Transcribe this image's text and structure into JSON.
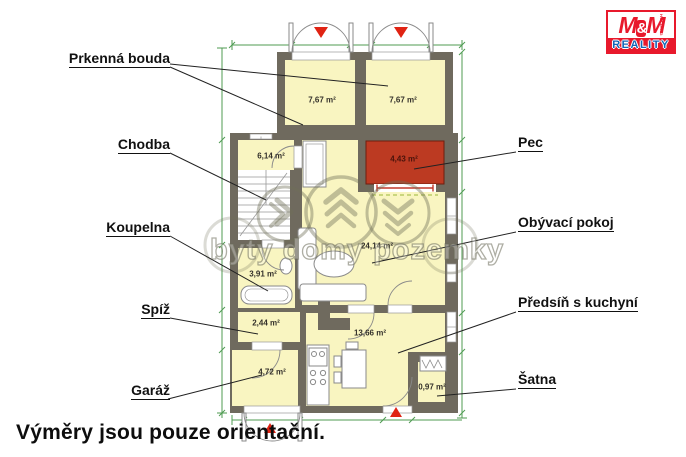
{
  "note": "Výměry jsou pouze orientační.",
  "watermark": "byty domy pozemky",
  "logo": {
    "m1": "M",
    "amp": "&",
    "m2": "M",
    "reality": "REALITY",
    "holding": "HOLDING"
  },
  "labels": {
    "prkenna_bouda": "Prkenná bouda",
    "chodba": "Chodba",
    "koupelna": "Koupelna",
    "spiz": "Spíž",
    "garaz": "Garáž",
    "pec": "Pec",
    "obyvaci_pokoj": "Obývací pokoj",
    "predsin": "Předsíň s kuchyní",
    "satna": "Šatna"
  },
  "areas": {
    "bouda_left": "7,67 m²",
    "bouda_right": "7,67 m²",
    "chodba": "6,14 m²",
    "pec": "4,43 m²",
    "obyvaci": "24,14 m²",
    "koupelna": "3,91 m²",
    "spiz": "2,44 m²",
    "garaz": "4,72 m²",
    "kuchyne": "13,66 m²",
    "satna": "0,97 m²"
  },
  "colors": {
    "room_fill": "#f9f5c1",
    "wall": "#6f6a5e",
    "pec_red": "#bc3a22",
    "dimension_green": "#4f9b52",
    "triangle_red": "#e02313",
    "logo_red": "#e8192c",
    "logo_blue": "#1466b8"
  }
}
